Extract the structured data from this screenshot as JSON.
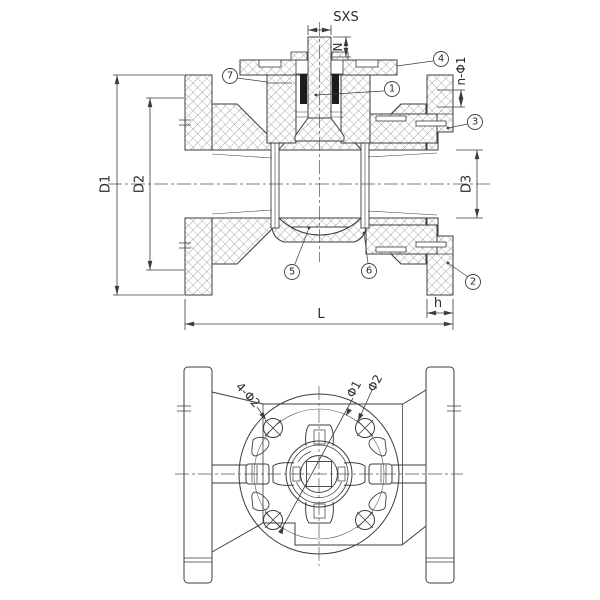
{
  "colors": {
    "line": "#3d3d3d",
    "hatch": "#6a6a6a",
    "packing": "#1c1c1c",
    "background": "#ffffff"
  },
  "front_section": {
    "dim_sxs": "SXS",
    "dim_n": "N",
    "dim_n_phi1": "n-Φ1",
    "dim_d1": "D1",
    "dim_d2": "D2",
    "dim_d3": "D3",
    "dim_l": "L",
    "dim_h": "h",
    "balloons": [
      {
        "label": "1"
      },
      {
        "label": "2"
      },
      {
        "label": "3"
      },
      {
        "label": "4"
      },
      {
        "label": "5"
      },
      {
        "label": "6"
      },
      {
        "label": "7"
      }
    ]
  },
  "plan_view": {
    "dim_bolt_holes": "4-Φ2",
    "dim_phi1": "Φ1",
    "dim_phi2": "Φ2"
  }
}
